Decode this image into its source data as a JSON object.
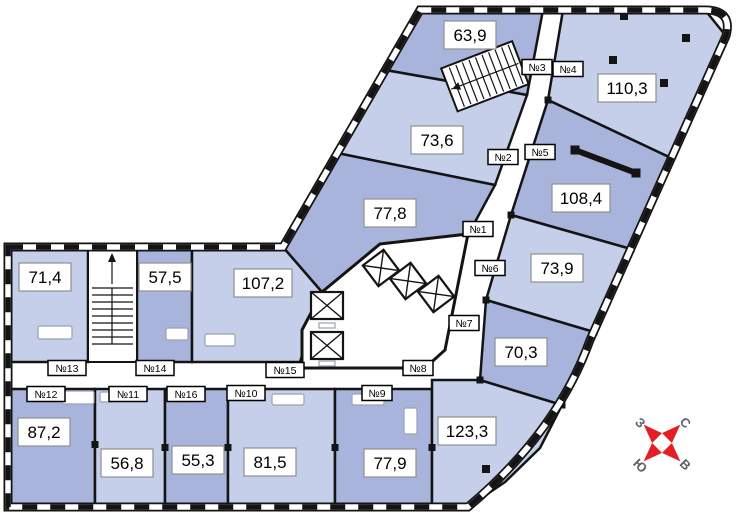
{
  "colors": {
    "room_light": "#c6cfe9",
    "room_dark": "#a8b4db",
    "wall": "#141414",
    "label_border": "#8f8f8f",
    "compass_red": "#e31e24",
    "compass_letter": "#5d6066"
  },
  "area_labels": [
    "63,9",
    "110,3",
    "73,6",
    "108,4",
    "77,8",
    "73,9",
    "70,3",
    "123,3",
    "107,2",
    "57,5",
    "71,4",
    "87,2",
    "56,8",
    "55,3",
    "81,5",
    "77,9"
  ],
  "apartment_tags": [
    "№1",
    "№2",
    "№3",
    "№4",
    "№5",
    "№6",
    "№7",
    "№8",
    "№9",
    "№10",
    "№11",
    "№12",
    "№13",
    "№14",
    "№15",
    "№16"
  ],
  "compass": {
    "north": "С",
    "east": "В",
    "south": "Ю",
    "west": "З"
  }
}
